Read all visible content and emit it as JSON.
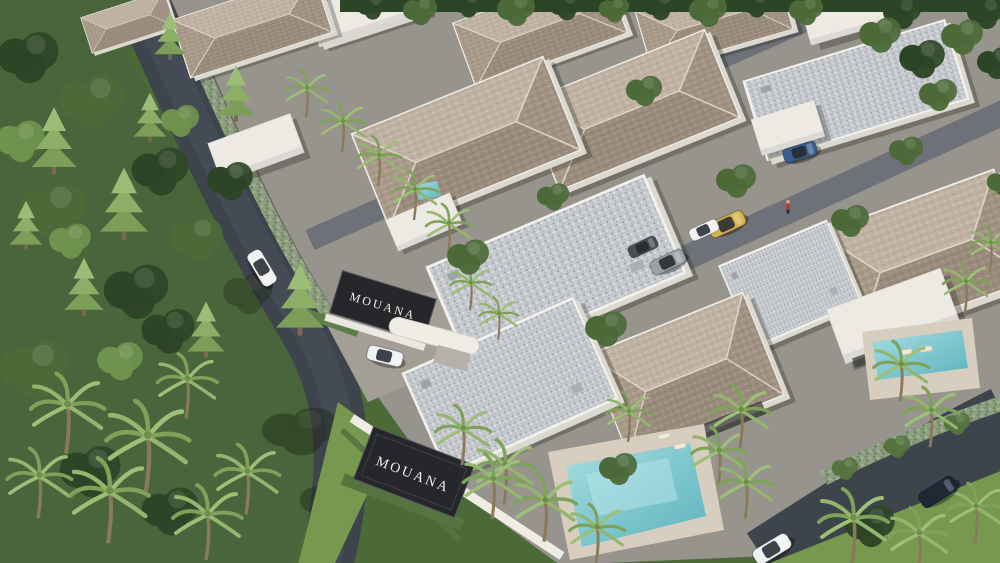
{
  "scene": {
    "description": "Aerial 3D rendering of the MOUANA tropical villa estate: rows of white villas with shingle hip roofs and gravel flat roofs, turquoise pools, palm trees, a jungle forest on the left, a curving asphalt road with a gated entrance, and parked cars"
  },
  "signs": {
    "entrance_label": "MOUANA",
    "wall_label": "MOUANA"
  },
  "colors": {
    "canopy-dark": "#2d4527",
    "canopy-mid": "#4c6a38",
    "canopy-light": "#6f934e",
    "lawn": "#76994f",
    "road": "#3d444c",
    "street": "#6e7278",
    "pavement": "#a39f97",
    "roof-tan": "#b3a492",
    "roof-gravel": "#c6c9cd",
    "roof-white": "#eceae3",
    "wall-white": "#efece6",
    "stone-wall": "#8c9f80",
    "hedge": "#55743f",
    "pool-light": "#a5dde0",
    "pool-deep": "#5db3bd",
    "deck": "#d7cec0",
    "sign-bg": "#25272b",
    "sign-text": "#f2efe9",
    "car-white": "#f0f1f2",
    "car-yellow": "#d4b34c",
    "car-silver": "#9ba1a7",
    "car-blue": "#3c5e8f",
    "car-navy": "#1c2738",
    "car-gray": "#4a4f54"
  }
}
